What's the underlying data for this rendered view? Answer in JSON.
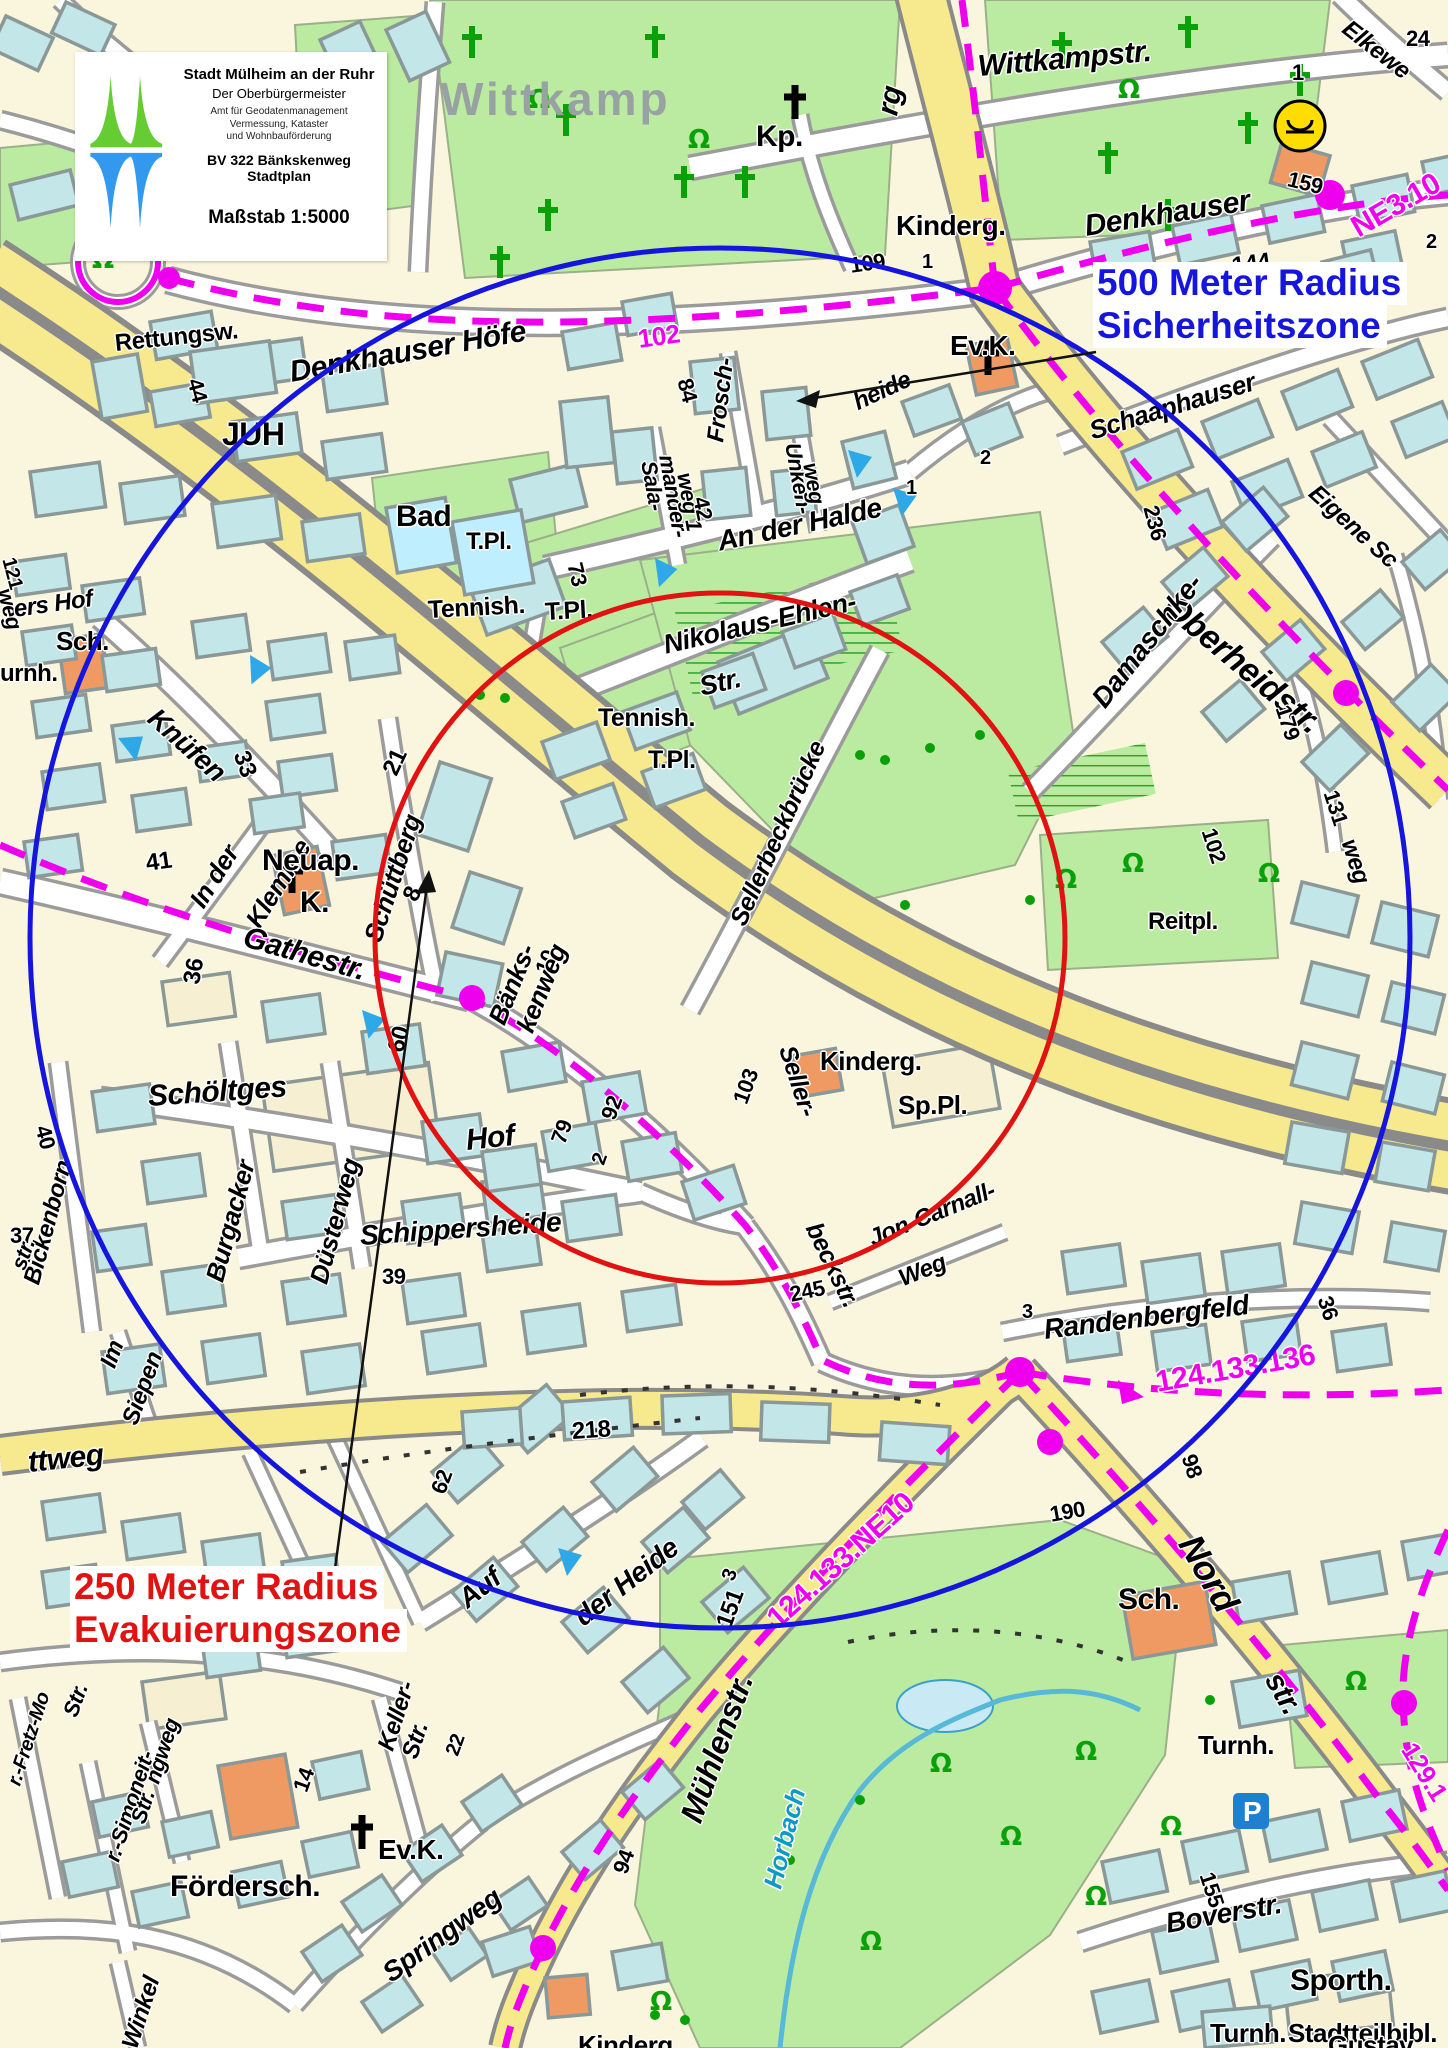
{
  "legend": {
    "title": "Stadt Mülheim an der Ruhr",
    "subtitle": "Der Oberbürgermeister",
    "dept_line1": "Amt für Geodatenmanagement",
    "dept_line2": "Vermessung, Kataster",
    "dept_line3": "und Wohnbauförderung",
    "project_line1": "BV 322  Bänkskenweg",
    "project_line2": "Stadtplan",
    "scale": "Maßstab 1:5000",
    "logo_colors": {
      "top": "#66cc33",
      "bottom": "#3399ee"
    }
  },
  "zones": {
    "security": {
      "line1": "500 Meter Radius",
      "line2": "Sicherheitszone",
      "color": "#1515dd",
      "radius_px": 690
    },
    "evacuation": {
      "line1": "250 Meter Radius",
      "line2": "Evakuierungszone",
      "color": "#e01212",
      "radius_px": 345
    },
    "center_x": 720,
    "center_y": 938
  },
  "colors": {
    "route_magenta": "#ee00ee",
    "road_yellow": "#f6e98e",
    "building_cyan": "#c3e6e8",
    "building_public_orange": "#ef9a63",
    "green_area": "#bbeba0",
    "water_label_cyan": "#1099c6"
  },
  "icons": {
    "post_office": "posthorn in yellow circle",
    "parking": "white P on blue square",
    "church": "black cross",
    "cemetery_grave": "green cross",
    "tree": "green omega symbol",
    "direction_marker": "blue triangle"
  },
  "district_label": {
    "text": "Wittkamp",
    "color": "#98a2a2"
  },
  "map_labels": [
    {
      "t": "rg",
      "x": 888,
      "y": 100,
      "r": -80,
      "s": 30,
      "i": 1
    },
    {
      "t": "Wittkampstr.",
      "x": 978,
      "y": 52,
      "r": -5,
      "s": 30,
      "i": 1
    },
    {
      "t": "Elkewe",
      "x": 1345,
      "y": 14,
      "r": 38,
      "s": 24,
      "i": 1
    },
    {
      "t": "24",
      "x": 1406,
      "y": 28,
      "r": 0,
      "s": 22
    },
    {
      "t": "1",
      "x": 1292,
      "y": 62,
      "r": 0,
      "s": 22
    },
    {
      "t": "Kp.",
      "x": 756,
      "y": 122,
      "r": 0,
      "s": 30
    },
    {
      "t": "Kinderg.",
      "x": 896,
      "y": 212,
      "r": 0,
      "s": 28
    },
    {
      "t": "1",
      "x": 922,
      "y": 252,
      "r": 0,
      "s": 20
    },
    {
      "t": "109",
      "x": 850,
      "y": 255,
      "r": -8,
      "s": 22
    },
    {
      "t": "Denkhauser",
      "x": 1085,
      "y": 212,
      "r": -9,
      "s": 30,
      "i": 1
    },
    {
      "t": "NE3.10",
      "x": 1354,
      "y": 215,
      "r": -30,
      "s": 30,
      "c": "#ee00ee"
    },
    {
      "t": "144",
      "x": 1232,
      "y": 255,
      "r": -8,
      "s": 24
    },
    {
      "t": "159",
      "x": 1288,
      "y": 168,
      "r": 14,
      "s": 22
    },
    {
      "t": "Ev.K.",
      "x": 950,
      "y": 332,
      "r": 0,
      "s": 28
    },
    {
      "t": "heide",
      "x": 855,
      "y": 392,
      "r": -25,
      "s": 24,
      "i": 1
    },
    {
      "t": "Schaaphauser",
      "x": 1090,
      "y": 418,
      "r": -17,
      "s": 26,
      "i": 1
    },
    {
      "t": "2",
      "x": 1426,
      "y": 232,
      "r": 0,
      "s": 20
    },
    {
      "t": "Eigene Sc",
      "x": 1312,
      "y": 478,
      "r": 42,
      "s": 24,
      "i": 1
    },
    {
      "t": "Oberheidstr.",
      "x": 1168,
      "y": 585,
      "r": 40,
      "s": 34,
      "i": 1
    },
    {
      "t": "236",
      "x": 1150,
      "y": 495,
      "r": 75,
      "s": 22
    },
    {
      "t": "179",
      "x": 1282,
      "y": 695,
      "r": 72,
      "s": 22
    },
    {
      "t": "131",
      "x": 1330,
      "y": 780,
      "r": 72,
      "s": 22
    },
    {
      "t": "102",
      "x": 1208,
      "y": 818,
      "r": 72,
      "s": 22
    },
    {
      "t": "weg",
      "x": 1348,
      "y": 828,
      "r": 72,
      "s": 24,
      "i": 1
    },
    {
      "t": "Damaschke-",
      "x": 1098,
      "y": 690,
      "r": -52,
      "s": 28,
      "i": 1
    },
    {
      "t": "Reitpl.",
      "x": 1148,
      "y": 910,
      "r": 0,
      "s": 24
    },
    {
      "t": "Denkhauser  Höfe",
      "x": 290,
      "y": 358,
      "r": -10,
      "s": 30,
      "i": 1
    },
    {
      "t": "102",
      "x": 638,
      "y": 326,
      "r": -8,
      "s": 26,
      "c": "#ee00ee"
    },
    {
      "t": "84",
      "x": 684,
      "y": 368,
      "r": 75,
      "s": 22
    },
    {
      "t": "JUH",
      "x": 222,
      "y": 418,
      "r": 0,
      "s": 32
    },
    {
      "t": "Rettungsw.",
      "x": 115,
      "y": 332,
      "r": -6,
      "s": 24
    },
    {
      "t": "44",
      "x": 194,
      "y": 368,
      "r": 75,
      "s": 22
    },
    {
      "t": "Sala-",
      "x": 648,
      "y": 450,
      "r": 80,
      "s": 22,
      "i": 1
    },
    {
      "t": "mander-",
      "x": 666,
      "y": 444,
      "r": 80,
      "s": 22,
      "i": 1
    },
    {
      "t": "weg 1",
      "x": 684,
      "y": 462,
      "r": 80,
      "s": 22,
      "i": 1
    },
    {
      "t": "42",
      "x": 700,
      "y": 486,
      "r": 78,
      "s": 22
    },
    {
      "t": "Frosch-",
      "x": 716,
      "y": 430,
      "r": -83,
      "s": 24,
      "i": 1
    },
    {
      "t": "Unken-",
      "x": 792,
      "y": 432,
      "r": 80,
      "s": 22,
      "i": 1
    },
    {
      "t": "weg",
      "x": 810,
      "y": 452,
      "r": 80,
      "s": 22,
      "i": 1
    },
    {
      "t": "2",
      "x": 980,
      "y": 448,
      "r": 0,
      "s": 20
    },
    {
      "t": "1",
      "x": 906,
      "y": 478,
      "r": 0,
      "s": 20
    },
    {
      "t": "An der Halde",
      "x": 718,
      "y": 528,
      "r": -12,
      "s": 28,
      "i": 1
    },
    {
      "t": "Bad",
      "x": 396,
      "y": 502,
      "r": 0,
      "s": 30
    },
    {
      "t": "T.Pl.",
      "x": 466,
      "y": 530,
      "r": 0,
      "s": 24
    },
    {
      "t": "73",
      "x": 574,
      "y": 552,
      "r": 76,
      "s": 22
    },
    {
      "t": "Tennish.",
      "x": 428,
      "y": 598,
      "r": -3,
      "s": 25
    },
    {
      "t": "T.Pl.",
      "x": 545,
      "y": 600,
      "r": -3,
      "s": 25
    },
    {
      "t": "Nikolaus-Ehlen-",
      "x": 664,
      "y": 632,
      "r": -13,
      "s": 27,
      "i": 1
    },
    {
      "t": "Str.",
      "x": 700,
      "y": 674,
      "r": -13,
      "s": 27,
      "i": 1
    },
    {
      "t": "Tennish.",
      "x": 598,
      "y": 706,
      "r": 0,
      "s": 25
    },
    {
      "t": "T.Pl.",
      "x": 648,
      "y": 748,
      "r": 0,
      "s": 25
    },
    {
      "t": "Sellerbeckbrücke",
      "x": 738,
      "y": 912,
      "r": -66,
      "s": 25,
      "i": 1
    },
    {
      "t": "121",
      "x": 8,
      "y": 548,
      "r": 75,
      "s": 20
    },
    {
      "t": "weg",
      "x": 4,
      "y": 578,
      "r": 75,
      "s": 22,
      "i": 1
    },
    {
      "t": "ers Hof",
      "x": 14,
      "y": 598,
      "r": -8,
      "s": 24,
      "i": 1
    },
    {
      "t": "Sch.",
      "x": 56,
      "y": 628,
      "r": 0,
      "s": 26
    },
    {
      "t": "urnh.",
      "x": 0,
      "y": 662,
      "r": 0,
      "s": 24
    },
    {
      "t": "Knüfen",
      "x": 152,
      "y": 700,
      "r": 42,
      "s": 28,
      "i": 1
    },
    {
      "t": "33",
      "x": 240,
      "y": 740,
      "r": 70,
      "s": 24
    },
    {
      "t": "41",
      "x": 146,
      "y": 852,
      "r": -8,
      "s": 24
    },
    {
      "t": "In der",
      "x": 196,
      "y": 892,
      "r": -58,
      "s": 26,
      "i": 1
    },
    {
      "t": "Klemme",
      "x": 252,
      "y": 912,
      "r": -58,
      "s": 26,
      "i": 1
    },
    {
      "t": "Neuap.",
      "x": 262,
      "y": 846,
      "r": 0,
      "s": 30
    },
    {
      "t": "K.",
      "x": 300,
      "y": 888,
      "r": 0,
      "s": 30
    },
    {
      "t": "Schüttberg",
      "x": 372,
      "y": 928,
      "r": -72,
      "s": 26,
      "i": 1
    },
    {
      "t": "21",
      "x": 390,
      "y": 762,
      "r": -65,
      "s": 24
    },
    {
      "t": "8",
      "x": 410,
      "y": 888,
      "r": -65,
      "s": 24
    },
    {
      "t": "Gathestr.",
      "x": 244,
      "y": 922,
      "r": 16,
      "s": 30,
      "i": 1
    },
    {
      "t": "36",
      "x": 192,
      "y": 972,
      "r": -80,
      "s": 24
    },
    {
      "t": "60",
      "x": 396,
      "y": 1040,
      "r": -75,
      "s": 24
    },
    {
      "t": "10",
      "x": 542,
      "y": 962,
      "r": -68,
      "s": 22
    },
    {
      "t": "Bänks-",
      "x": 496,
      "y": 1010,
      "r": -68,
      "s": 26,
      "i": 1
    },
    {
      "t": "kenweg",
      "x": 524,
      "y": 1018,
      "r": -68,
      "s": 26,
      "i": 1
    },
    {
      "t": "92",
      "x": 608,
      "y": 1108,
      "r": -70,
      "s": 22
    },
    {
      "t": "79",
      "x": 558,
      "y": 1132,
      "r": -70,
      "s": 22
    },
    {
      "t": "2",
      "x": 598,
      "y": 1154,
      "r": -70,
      "s": 20
    },
    {
      "t": "103",
      "x": 740,
      "y": 1092,
      "r": -70,
      "s": 22
    },
    {
      "t": "Seller-",
      "x": 786,
      "y": 1034,
      "r": 72,
      "s": 25,
      "i": 1
    },
    {
      "t": "beckstr.",
      "x": 812,
      "y": 1212,
      "r": 64,
      "s": 25,
      "i": 1
    },
    {
      "t": "Kinderg.",
      "x": 820,
      "y": 1048,
      "r": 0,
      "s": 26
    },
    {
      "t": "Sp.Pl.",
      "x": 898,
      "y": 1092,
      "r": 0,
      "s": 26
    },
    {
      "t": "Schöltges",
      "x": 148,
      "y": 1082,
      "r": -4,
      "s": 30,
      "i": 1
    },
    {
      "t": "Hof",
      "x": 466,
      "y": 1126,
      "r": -6,
      "s": 30,
      "i": 1
    },
    {
      "t": "40",
      "x": 42,
      "y": 1115,
      "r": 75,
      "s": 22
    },
    {
      "t": "Bickenborn",
      "x": 32,
      "y": 1272,
      "r": -75,
      "s": 24,
      "i": 1
    },
    {
      "t": "37",
      "x": 10,
      "y": 1225,
      "r": 0,
      "s": 22
    },
    {
      "t": "str.",
      "x": 18,
      "y": 1258,
      "r": -70,
      "s": 22,
      "i": 1
    },
    {
      "t": "Im",
      "x": 108,
      "y": 1355,
      "r": -70,
      "s": 24,
      "i": 1
    },
    {
      "t": "Siepen",
      "x": 130,
      "y": 1412,
      "r": -70,
      "s": 24,
      "i": 1
    },
    {
      "t": "Burgacker",
      "x": 214,
      "y": 1268,
      "r": -75,
      "s": 26,
      "i": 1
    },
    {
      "t": "Düsterweg",
      "x": 318,
      "y": 1270,
      "r": -75,
      "s": 26,
      "i": 1
    },
    {
      "t": "39",
      "x": 382,
      "y": 1266,
      "r": 0,
      "s": 22
    },
    {
      "t": "Schippersheide",
      "x": 360,
      "y": 1222,
      "r": -4,
      "s": 28,
      "i": 1
    },
    {
      "t": "245",
      "x": 790,
      "y": 1284,
      "r": -12,
      "s": 22
    },
    {
      "t": "Jon-Carnall-",
      "x": 870,
      "y": 1228,
      "r": -22,
      "s": 24,
      "i": 1
    },
    {
      "t": "Weg",
      "x": 900,
      "y": 1268,
      "r": -22,
      "s": 24,
      "i": 1
    },
    {
      "t": "3",
      "x": 1022,
      "y": 1302,
      "r": 0,
      "s": 20
    },
    {
      "t": "Randenbergfeld",
      "x": 1044,
      "y": 1316,
      "r": -7,
      "s": 28,
      "i": 1
    },
    {
      "t": "36",
      "x": 1324,
      "y": 1286,
      "r": 72,
      "s": 22
    },
    {
      "t": "124.133.136",
      "x": 1156,
      "y": 1368,
      "r": -10,
      "s": 30,
      "c": "#ee00ee"
    },
    {
      "t": "98",
      "x": 1188,
      "y": 1444,
      "r": 72,
      "s": 22
    },
    {
      "t": "190",
      "x": 1050,
      "y": 1504,
      "r": -10,
      "s": 22
    },
    {
      "t": "Nord",
      "x": 1188,
      "y": 1520,
      "r": 60,
      "s": 36,
      "i": 1
    },
    {
      "t": "str.",
      "x": 1272,
      "y": 1660,
      "r": 60,
      "s": 30,
      "i": 1
    },
    {
      "t": "129.1",
      "x": 1408,
      "y": 1732,
      "r": 58,
      "s": 26,
      "c": "#ee00ee"
    },
    {
      "t": "124.133.NE10",
      "x": 772,
      "y": 1608,
      "r": -42,
      "s": 30,
      "c": "#ee00ee"
    },
    {
      "t": "ttweg",
      "x": 28,
      "y": 1448,
      "r": -6,
      "s": 30,
      "i": 1
    },
    {
      "t": "218",
      "x": 572,
      "y": 1420,
      "r": -4,
      "s": 24
    },
    {
      "t": "62",
      "x": 438,
      "y": 1482,
      "r": -70,
      "s": 22
    },
    {
      "t": "Auf",
      "x": 462,
      "y": 1588,
      "r": -38,
      "s": 28,
      "i": 1
    },
    {
      "t": "der Heide",
      "x": 578,
      "y": 1606,
      "r": -38,
      "s": 28,
      "i": 1
    },
    {
      "t": "3",
      "x": 728,
      "y": 1570,
      "r": -70,
      "s": 20
    },
    {
      "t": "151",
      "x": 724,
      "y": 1615,
      "r": -70,
      "s": 24
    },
    {
      "t": "Sch.",
      "x": 1118,
      "y": 1585,
      "r": 0,
      "s": 30
    },
    {
      "t": "Turnh.",
      "x": 1198,
      "y": 1732,
      "r": 0,
      "s": 26
    },
    {
      "t": "Mühlenstr.",
      "x": 690,
      "y": 1805,
      "r": -70,
      "s": 32,
      "i": 1
    },
    {
      "t": "Horbach",
      "x": 772,
      "y": 1875,
      "r": -76,
      "s": 26,
      "i": 1,
      "c": "#1099c6"
    },
    {
      "t": "94",
      "x": 620,
      "y": 1862,
      "r": -70,
      "s": 22
    },
    {
      "t": "r.-Fretz-Mo",
      "x": 14,
      "y": 1775,
      "r": -72,
      "s": 20,
      "i": 1
    },
    {
      "t": "Str.",
      "x": 70,
      "y": 1705,
      "r": -70,
      "s": 22,
      "i": 1
    },
    {
      "t": "r.-Simoneit-",
      "x": 112,
      "y": 1850,
      "r": -72,
      "s": 22,
      "i": 1
    },
    {
      "t": "Str.",
      "x": 138,
      "y": 1812,
      "r": -72,
      "s": 22,
      "i": 1
    },
    {
      "t": "ngweg",
      "x": 152,
      "y": 1772,
      "r": -72,
      "s": 22,
      "i": 1
    },
    {
      "t": "14",
      "x": 300,
      "y": 1780,
      "r": -70,
      "s": 22
    },
    {
      "t": "22",
      "x": 452,
      "y": 1745,
      "r": -70,
      "s": 20
    },
    {
      "t": "Keller-",
      "x": 386,
      "y": 1738,
      "r": -72,
      "s": 24,
      "i": 1
    },
    {
      "t": "Str.",
      "x": 410,
      "y": 1746,
      "r": -72,
      "s": 24,
      "i": 1
    },
    {
      "t": "Ev.K.",
      "x": 378,
      "y": 1836,
      "r": 0,
      "s": 28
    },
    {
      "t": "Fördersch.",
      "x": 170,
      "y": 1872,
      "r": 0,
      "s": 30
    },
    {
      "t": "Springweg",
      "x": 386,
      "y": 1962,
      "r": -36,
      "s": 28,
      "i": 1
    },
    {
      "t": "Winkel",
      "x": 130,
      "y": 2036,
      "r": -72,
      "s": 24,
      "i": 1
    },
    {
      "t": "Kinderg.",
      "x": 578,
      "y": 2032,
      "r": 0,
      "s": 26
    },
    {
      "t": "Boverstr.",
      "x": 1166,
      "y": 1910,
      "r": -10,
      "s": 28,
      "i": 1
    },
    {
      "t": "155",
      "x": 1206,
      "y": 1862,
      "r": 72,
      "s": 22
    },
    {
      "t": "Sporth.",
      "x": 1290,
      "y": 1966,
      "r": 0,
      "s": 30
    },
    {
      "t": "Turnh.",
      "x": 1210,
      "y": 2020,
      "r": 0,
      "s": 26
    },
    {
      "t": "Stadtteilbibl.",
      "x": 1288,
      "y": 2020,
      "r": 0,
      "s": 26
    },
    {
      "t": "Gustav",
      "x": 1328,
      "y": 2032,
      "r": 0,
      "s": 26
    }
  ]
}
